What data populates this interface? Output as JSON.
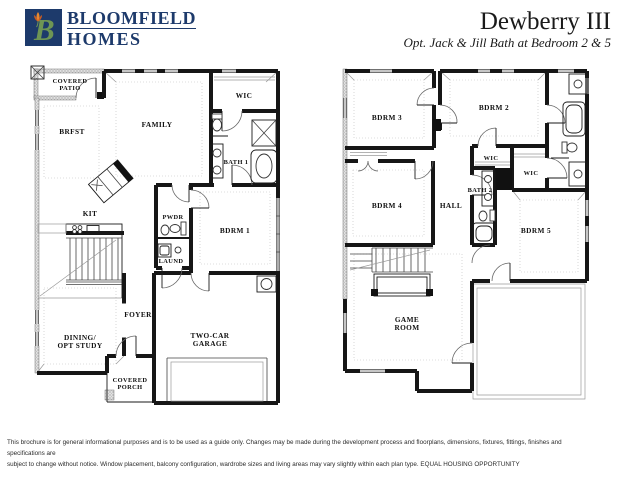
{
  "logo": {
    "monogram": "B",
    "line1": "BLOOMFIELD",
    "line2": "HOMES",
    "navy": "#1d3a6b",
    "green": "#6e9554",
    "tulip": "#e8872e",
    "tulip_dark": "#c75b22"
  },
  "header": {
    "title": "Dewberry III",
    "subtitle": "Opt. Jack & Jill Bath at Bedroom 2 & 5"
  },
  "floor1": {
    "rooms": {
      "covered_patio1": "COVERED",
      "covered_patio2": "PATIO",
      "brfst": "BRFST",
      "family": "FAMILY",
      "wic": "WIC",
      "bath1": "BATH 1",
      "kit": "KIT",
      "pwdr": "PWDR",
      "bdrm1": "BDRM 1",
      "laund": "LAUND",
      "foyer": "FOYER",
      "dining1": "DINING/",
      "dining2": "OPT STUDY",
      "garage1": "TWO-CAR",
      "garage2": "GARAGE",
      "porch1": "COVERED",
      "porch2": "PORCH"
    }
  },
  "floor2": {
    "rooms": {
      "bdrm3": "BDRM 3",
      "bdrm2": "BDRM 2",
      "wic_a": "WIC",
      "wic_b": "WIC",
      "bath2": "BATH 2",
      "bdrm4": "BDRM 4",
      "hall": "HALL",
      "bdrm5": "BDRM 5",
      "game1": "GAME",
      "game2": "ROOM"
    }
  },
  "footer": {
    "line1": "This brochure is for general informational purposes and is to be used as a guide only. Changes may be made during the development process and floorplans, dimensions, fixtures, fittings, finishes and specifications are",
    "line2": "subject to change without notice. Window placement, balcony configuration, wardrobe sizes and living areas may vary slightly within each plan type.  EQUAL HOUSING OPPORTUNITY"
  }
}
